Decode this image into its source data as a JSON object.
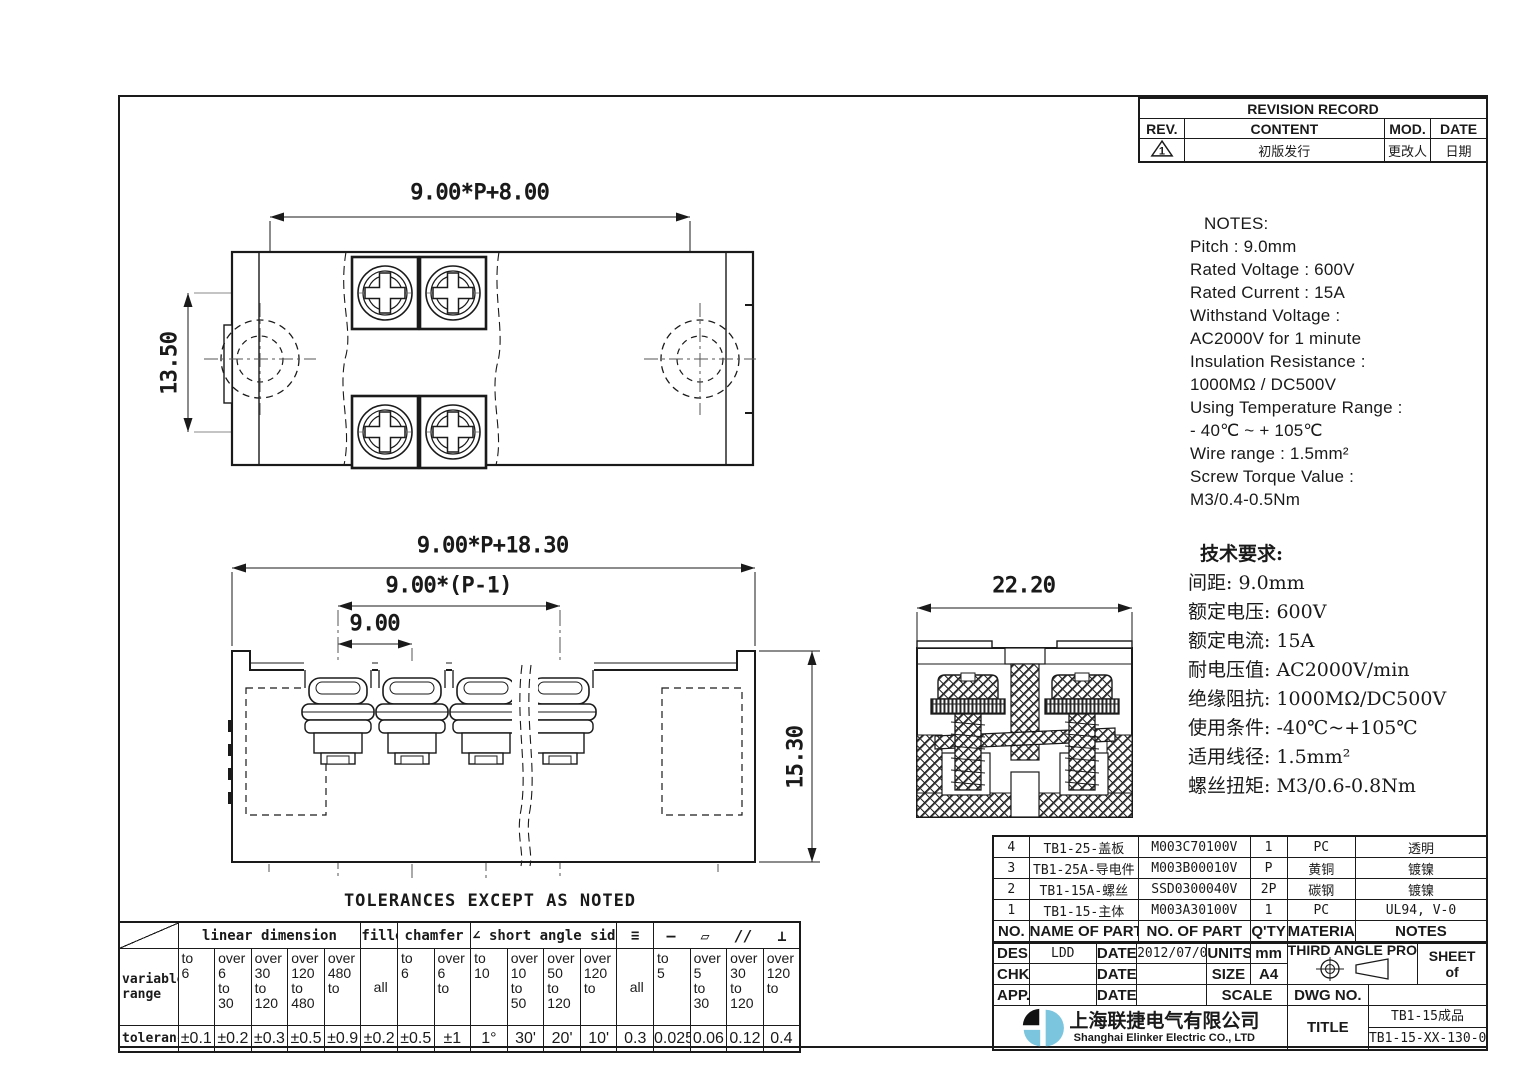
{
  "colors": {
    "line": "#1a1a1a",
    "logo_blue": "#7cc5de",
    "logo_black": "#111111"
  },
  "revision": {
    "title": "REVISION RECORD",
    "col_rev": "REV.",
    "col_content": "CONTENT",
    "col_mod": "MOD.",
    "col_date": "DATE",
    "rev_mark": "1",
    "content": "初版发行",
    "mod": "更改人",
    "date": "日期"
  },
  "notes": {
    "title": "NOTES:",
    "lines": [
      "Pitch :  9.0mm",
      "Rated  Voltage :  600V",
      "Rated  Current :  15A",
      "Withstand Voltage :",
      "AC2000V  for 1 minute",
      "Insulation Resistance :",
      "1000MΩ / DC500V",
      "Using Temperature Range :",
      "- 40℃ ~  + 105℃",
      "Wire  range : 1.5mm²",
      "Screw Torque Value :",
      "M3/0.4-0.5Nm"
    ]
  },
  "tech": {
    "title": "技术要求:",
    "lines": [
      "间距: 9.0mm",
      "额定电压: 600V",
      "额定电流: 15A",
      "耐电压值: AC2000V/min",
      "绝缘阻抗: 1000MΩ/DC500V",
      "使用条件: -40℃~+105℃",
      "适用线径: 1.5mm²",
      "螺丝扭矩: M3/0.6-0.8Nm"
    ]
  },
  "dims": {
    "top_width": "9.00*P+8.00",
    "top_height": "13.50",
    "front_width": "9.00*P+18.30",
    "front_span": "9.00*(P-1)",
    "front_pitch": "9.00",
    "front_height": "15.30",
    "side_width": "22.20"
  },
  "bom": {
    "headers": [
      "NO.",
      "NAME OF PART",
      "NO. OF PART",
      "Q'TY",
      "MATERIAL",
      "NOTES"
    ],
    "rows": [
      {
        "no": "4",
        "name": "TB1-25-盖板",
        "part": "M003C70100V",
        "qty": "1",
        "material": "PC",
        "note": "透明"
      },
      {
        "no": "3",
        "name": "TB1-25A-导电件",
        "part": "M003B00010V",
        "qty": "P",
        "material": "黄铜",
        "note": "镀镍"
      },
      {
        "no": "2",
        "name": "TB1-15A-螺丝",
        "part": "SSD0300040V",
        "qty": "2P",
        "material": "碳钢",
        "note": "镀镍"
      },
      {
        "no": "1",
        "name": "TB1-15-主体",
        "part": "M003A30100V",
        "qty": "1",
        "material": "PC",
        "note": "UL94, V-0"
      }
    ]
  },
  "tb": {
    "des_label": "DES.",
    "des_value": "LDD",
    "date_label": "DATE",
    "date_value": "2012/07/03",
    "units_label": "UNITS",
    "units_value": "mm",
    "chk_label": "CHK.",
    "size_label": "SIZE",
    "size_value": "A4",
    "app_label": "APP.",
    "scale_label": "SCALE",
    "projection_label": "THIRD ANGLE PROJECTION",
    "sheet_label": "SHEET",
    "sheet_of": "of",
    "dwg_label": "DWG NO.",
    "title_label": "TITLE",
    "company_cn": "上海联捷电气有限公司",
    "company_en": "Shanghai Elinker Electric CO., LTD",
    "title_value1": "TB1-15成品",
    "title_value2": "TB1-15-XX-130-00A"
  },
  "tol": {
    "title": "TOLERANCES EXCEPT AS NOTED",
    "label_range": "variable\nrange",
    "label_tol": "tolerance",
    "groups": {
      "linear": "linear dimension",
      "fillet": "fillet",
      "chamfer": "chamfer",
      "angle": "short angle sid",
      "angle_icon": "∠",
      "sym_icon": "≡",
      "icons": [
        "—",
        "▱",
        "//",
        "⊥"
      ]
    },
    "cols": [
      {
        "r": "to\n6",
        "t": "±0.1"
      },
      {
        "r": "over\n6\nto\n30",
        "t": "±0.2"
      },
      {
        "r": "over\n30\nto\n120",
        "t": "±0.3"
      },
      {
        "r": "over\n120\nto\n480",
        "t": "±0.5"
      },
      {
        "r": "over\n480\nto",
        "t": "±0.9"
      },
      {
        "r": "all",
        "t": "±0.2"
      },
      {
        "r": "to\n6",
        "t": "±0.5"
      },
      {
        "r": "over\n6\nto",
        "t": "±1"
      },
      {
        "r": "to\n10",
        "t": "1°"
      },
      {
        "r": "over\n10\nto\n50",
        "t": "30'"
      },
      {
        "r": "over\n50\nto\n120",
        "t": "20'"
      },
      {
        "r": "over\n120\nto",
        "t": "10'"
      },
      {
        "r": "all",
        "t": "0.3"
      },
      {
        "r": "to\n5",
        "t": "0.025"
      },
      {
        "r": "over\n5\nto\n30",
        "t": "0.06"
      },
      {
        "r": "over\n30\nto\n120",
        "t": "0.12"
      },
      {
        "r": "over\n120\nto",
        "t": "0.4"
      }
    ]
  }
}
